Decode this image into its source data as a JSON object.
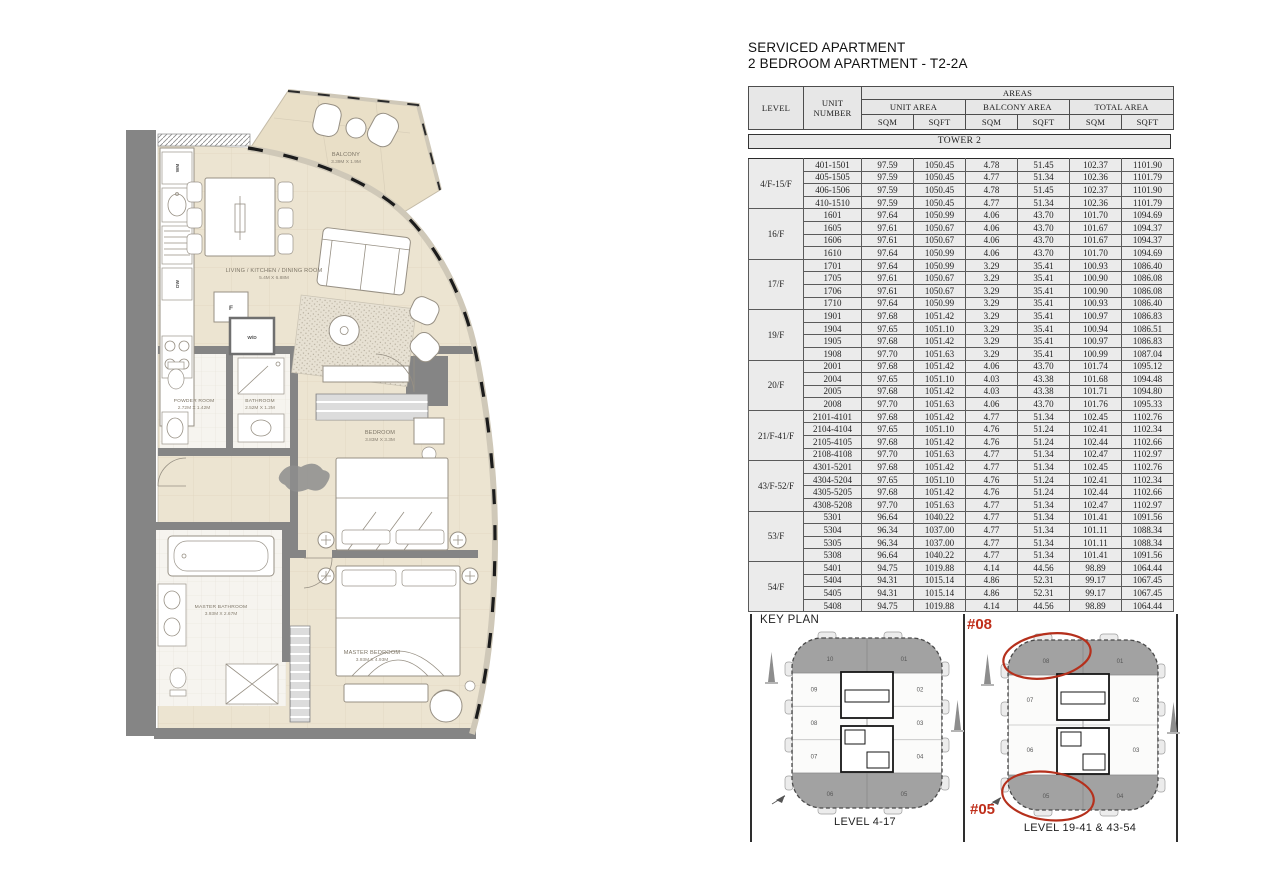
{
  "header": {
    "title_line1": "SERVICED APARTMENT",
    "title_line2": "2 BEDROOM APARTMENT - T2-2A"
  },
  "table": {
    "col_level": "LEVEL",
    "col_unit": "UNIT NUMBER",
    "col_areas": "AREAS",
    "col_unit_area": "UNIT AREA",
    "col_balcony_area": "BALCONY AREA",
    "col_total_area": "TOTAL AREA",
    "sqm": "SQM",
    "sqft": "SQFT",
    "tower_banner": "TOWER 2",
    "groups": [
      {
        "level": "4/F-15/F",
        "rows": [
          {
            "unit": "401-1501",
            "v": [
              "97.59",
              "1050.45",
              "4.78",
              "51.45",
              "102.37",
              "1101.90"
            ]
          },
          {
            "unit": "405-1505",
            "v": [
              "97.59",
              "1050.45",
              "4.77",
              "51.34",
              "102.36",
              "1101.79"
            ]
          },
          {
            "unit": "406-1506",
            "v": [
              "97.59",
              "1050.45",
              "4.78",
              "51.45",
              "102.37",
              "1101.90"
            ]
          },
          {
            "unit": "410-1510",
            "v": [
              "97.59",
              "1050.45",
              "4.77",
              "51.34",
              "102.36",
              "1101.79"
            ]
          }
        ]
      },
      {
        "level": "16/F",
        "rows": [
          {
            "unit": "1601",
            "v": [
              "97.64",
              "1050.99",
              "4.06",
              "43.70",
              "101.70",
              "1094.69"
            ]
          },
          {
            "unit": "1605",
            "v": [
              "97.61",
              "1050.67",
              "4.06",
              "43.70",
              "101.67",
              "1094.37"
            ]
          },
          {
            "unit": "1606",
            "v": [
              "97.61",
              "1050.67",
              "4.06",
              "43.70",
              "101.67",
              "1094.37"
            ]
          },
          {
            "unit": "1610",
            "v": [
              "97.64",
              "1050.99",
              "4.06",
              "43.70",
              "101.70",
              "1094.69"
            ]
          }
        ]
      },
      {
        "level": "17/F",
        "rows": [
          {
            "unit": "1701",
            "v": [
              "97.64",
              "1050.99",
              "3.29",
              "35.41",
              "100.93",
              "1086.40"
            ]
          },
          {
            "unit": "1705",
            "v": [
              "97.61",
              "1050.67",
              "3.29",
              "35.41",
              "100.90",
              "1086.08"
            ]
          },
          {
            "unit": "1706",
            "v": [
              "97.61",
              "1050.67",
              "3.29",
              "35.41",
              "100.90",
              "1086.08"
            ]
          },
          {
            "unit": "1710",
            "v": [
              "97.64",
              "1050.99",
              "3.29",
              "35.41",
              "100.93",
              "1086.40"
            ]
          }
        ]
      },
      {
        "level": "19/F",
        "rows": [
          {
            "unit": "1901",
            "v": [
              "97.68",
              "1051.42",
              "3.29",
              "35.41",
              "100.97",
              "1086.83"
            ]
          },
          {
            "unit": "1904",
            "v": [
              "97.65",
              "1051.10",
              "3.29",
              "35.41",
              "100.94",
              "1086.51"
            ]
          },
          {
            "unit": "1905",
            "v": [
              "97.68",
              "1051.42",
              "3.29",
              "35.41",
              "100.97",
              "1086.83"
            ]
          },
          {
            "unit": "1908",
            "v": [
              "97.70",
              "1051.63",
              "3.29",
              "35.41",
              "100.99",
              "1087.04"
            ]
          }
        ]
      },
      {
        "level": "20/F",
        "rows": [
          {
            "unit": "2001",
            "v": [
              "97.68",
              "1051.42",
              "4.06",
              "43.70",
              "101.74",
              "1095.12"
            ]
          },
          {
            "unit": "2004",
            "v": [
              "97.65",
              "1051.10",
              "4.03",
              "43.38",
              "101.68",
              "1094.48"
            ]
          },
          {
            "unit": "2005",
            "v": [
              "97.68",
              "1051.42",
              "4.03",
              "43.38",
              "101.71",
              "1094.80"
            ]
          },
          {
            "unit": "2008",
            "v": [
              "97.70",
              "1051.63",
              "4.06",
              "43.70",
              "101.76",
              "1095.33"
            ]
          }
        ]
      },
      {
        "level": "21/F-41/F",
        "rows": [
          {
            "unit": "2101-4101",
            "v": [
              "97.68",
              "1051.42",
              "4.77",
              "51.34",
              "102.45",
              "1102.76"
            ]
          },
          {
            "unit": "2104-4104",
            "v": [
              "97.65",
              "1051.10",
              "4.76",
              "51.24",
              "102.41",
              "1102.34"
            ]
          },
          {
            "unit": "2105-4105",
            "v": [
              "97.68",
              "1051.42",
              "4.76",
              "51.24",
              "102.44",
              "1102.66"
            ]
          },
          {
            "unit": "2108-4108",
            "v": [
              "97.70",
              "1051.63",
              "4.77",
              "51.34",
              "102.47",
              "1102.97"
            ]
          }
        ]
      },
      {
        "level": "43/F-52/F",
        "rows": [
          {
            "unit": "4301-5201",
            "v": [
              "97.68",
              "1051.42",
              "4.77",
              "51.34",
              "102.45",
              "1102.76"
            ]
          },
          {
            "unit": "4304-5204",
            "v": [
              "97.65",
              "1051.10",
              "4.76",
              "51.24",
              "102.41",
              "1102.34"
            ]
          },
          {
            "unit": "4305-5205",
            "v": [
              "97.68",
              "1051.42",
              "4.76",
              "51.24",
              "102.44",
              "1102.66"
            ]
          },
          {
            "unit": "4308-5208",
            "v": [
              "97.70",
              "1051.63",
              "4.77",
              "51.34",
              "102.47",
              "1102.97"
            ]
          }
        ]
      },
      {
        "level": "53/F",
        "rows": [
          {
            "unit": "5301",
            "v": [
              "96.64",
              "1040.22",
              "4.77",
              "51.34",
              "101.41",
              "1091.56"
            ]
          },
          {
            "unit": "5304",
            "v": [
              "96.34",
              "1037.00",
              "4.77",
              "51.34",
              "101.11",
              "1088.34"
            ]
          },
          {
            "unit": "5305",
            "v": [
              "96.34",
              "1037.00",
              "4.77",
              "51.34",
              "101.11",
              "1088.34"
            ]
          },
          {
            "unit": "5308",
            "v": [
              "96.64",
              "1040.22",
              "4.77",
              "51.34",
              "101.41",
              "1091.56"
            ]
          }
        ]
      },
      {
        "level": "54/F",
        "rows": [
          {
            "unit": "5401",
            "v": [
              "94.75",
              "1019.88",
              "4.14",
              "44.56",
              "98.89",
              "1064.44"
            ]
          },
          {
            "unit": "5404",
            "v": [
              "94.31",
              "1015.14",
              "4.86",
              "52.31",
              "99.17",
              "1067.45"
            ]
          },
          {
            "unit": "5405",
            "v": [
              "94.31",
              "1015.14",
              "4.86",
              "52.31",
              "99.17",
              "1067.45"
            ]
          },
          {
            "unit": "5408",
            "v": [
              "94.75",
              "1019.88",
              "4.14",
              "44.56",
              "98.89",
              "1064.44"
            ]
          }
        ]
      }
    ]
  },
  "key_plan": {
    "title": "KEY PLAN",
    "plans": [
      {
        "caption": "LEVEL 4-17",
        "top": [
          "10",
          "01"
        ],
        "left": [
          "09",
          "08",
          "07"
        ],
        "right": [
          "02",
          "03",
          "04"
        ],
        "bottom": [
          "06",
          "05"
        ],
        "highlights": []
      },
      {
        "caption": "LEVEL 19-41 & 43-54",
        "top": [
          "08",
          "01"
        ],
        "left": [
          "07",
          "06"
        ],
        "right": [
          "02",
          "03"
        ],
        "bottom": [
          "05",
          "04"
        ],
        "highlights": [
          "top-left",
          "bottom-left"
        ],
        "tag_top": "#08",
        "tag_bottom": "#05"
      }
    ]
  },
  "floor_plan": {
    "balcony": {
      "name": "BALCONY",
      "dims": "3.39M X 1.9M"
    },
    "living": {
      "name": "LIVING / KITCHEN / DINING ROOM",
      "dims": "5.4M X 6.88M"
    },
    "powder": {
      "name": "POWDER ROOM",
      "dims": "2.72M X 1.42M"
    },
    "bathroom": {
      "name": "BATHROOM",
      "dims": "2.52M X 1.2M"
    },
    "bedroom": {
      "name": "BEDROOM",
      "dims": "3.83M X 3.3M"
    },
    "master_bathroom": {
      "name": "MASTER BATHROOM",
      "dims": "3.93M X 2.67M"
    },
    "master_bedroom": {
      "name": "MASTER BEDROOM",
      "dims": "3.93M X 4.93M"
    },
    "labels": {
      "wm": "WM",
      "dw": "DW",
      "f": "F",
      "wd": "W/D"
    }
  }
}
